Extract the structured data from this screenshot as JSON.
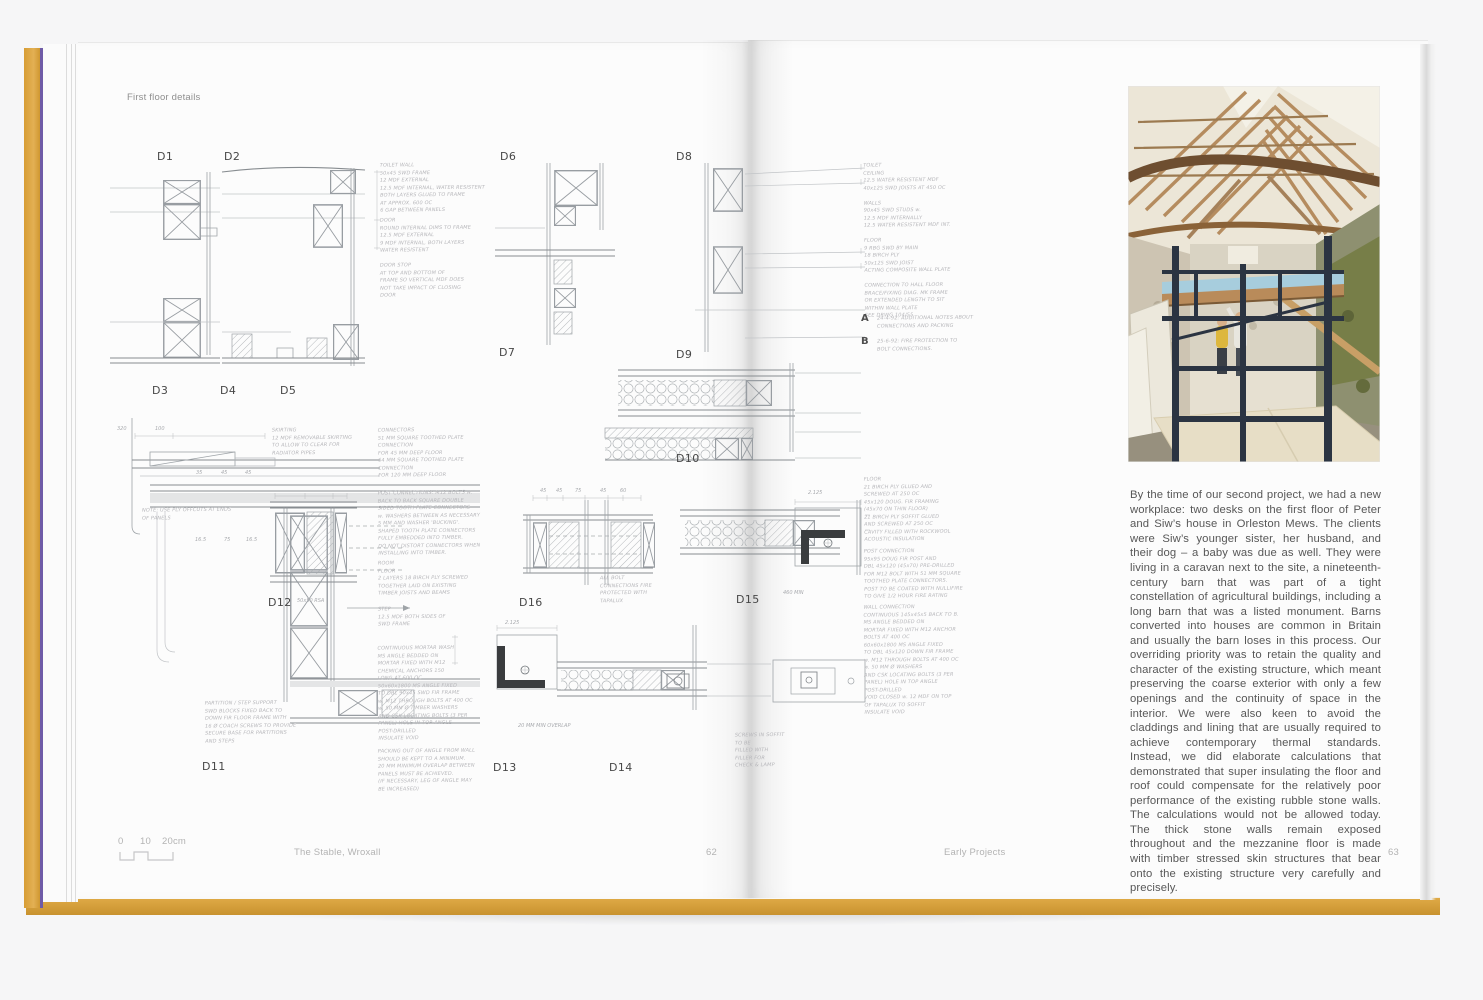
{
  "book": {
    "left_page": {
      "header": "First floor details",
      "footer": {
        "scale_zero": "0",
        "scale_ten": "10",
        "scale_twenty": "20cm",
        "title": "The Stable, Wroxall",
        "page_number": "62"
      }
    },
    "right_page": {
      "footer": {
        "title": "Early Projects",
        "page_number": "63"
      },
      "paragraph": "By the time of our second project, we had a new workplace: two desks on the first floor of Peter and Siw’s house in Orleston Mews. The clients were Siw’s younger sister, her husband, and their dog – a baby was due as well. They were living in a caravan next to the site, a nineteenth-century barn that was part of a tight constellation of agricultural buildings, including a long barn that was a listed monument. Barns converted into houses are common in Britain and usually the barn loses in this process. Our overriding priority was to retain the quality and character of the existing structure, which meant preserving the coarse exterior with only a few openings and the continuity of space in the interior. We were also keen to avoid the claddings and lining that are usually required to achieve contemporary thermal standards. Instead, we did elaborate calculations that demonstrated that super insulating the floor and roof could compensate for the relatively poor performance of the existing rubble stone walls. The calculations would not be allowed today. The thick stone walls remain exposed throughout and the mezzanine floor is made with timber stressed skin structures that bear onto the existing structure very carefully and precisely."
    },
    "drawing": {
      "labels": {
        "d1": "D1",
        "d2": "D2",
        "d3": "D3",
        "d4": "D4",
        "d5": "D5",
        "d6": "D6",
        "d7": "D7",
        "d8": "D8",
        "d9": "D9",
        "d10": "D10",
        "d11": "D11",
        "d12": "D12",
        "d13": "D13",
        "d14": "D14",
        "d15": "D15",
        "d16": "D16"
      },
      "markers": {
        "a": {
          "letter": "A",
          "text": "24-4-92: ADDITIONAL NOTES ABOUT\nCONNECTIONS AND PACKING"
        },
        "b": {
          "letter": "B",
          "text": "25-6-92: FIRE PROTECTION TO\nBOLT CONNECTIONS."
        }
      },
      "notes": {
        "toilet_wall": "TOILET WALL\n50x45 SWD FRAME\n12 MDF EXTERNAL\n12.5 MDF INTERNAL, WATER RESISTENT\nBOTH LAYERS GLUED TO FRAME\nAT APPROX. 600 OC\n6 GAP BETWEEN PANELS",
        "door": "DOOR\nROUND INTERNAL DIMS TO FRAME\n12.5 MDF EXTERNAL\n9 MDF INTERNAL, BOTH LAYERS\nWATER RESISTENT",
        "door_stop": "DOOR STOP\nAT TOP AND BOTTOM OF\nFRAME SO VERTICAL MDF DOES\nNOT TAKE IMPACT OF CLOSING\nDOOR",
        "toilet_schedule": "TOILET\nCEILING\n12.5 WATER RESISTENT MDF\n40x125 SWD JOISTS AT 450 OC\n\nWALLS\n90x45 SWD STUDS w.\n12.5 MDF INTERNALLY\n12.5 WATER RESISTENT MDF INT.\n\nFLOOR\n9 RBG SWD BY MAIN\n18 BIRCH PLY\n50x125 SWD JOIST\nACTING COMPOSITE WALL PLATE\n\nCONNECTION TO HALL FLOOR\nBRACE/FIXING DIAG. MK FRAME\nOR EXTENDED LENGTH TO SIT\nWITHIN WALL PLATE\nSEE DRWG 104/55",
        "skirting": "SKIRTING\n12 MDF REMOVABLE SKIRTING\nTO ALLOW TO CLEAR FOR\nRADIATOR PIPES",
        "connectors": "CONNECTORS\n51 MM SQUARE TOOTHED PLATE CONNECTION\nFOR 45 MM DEEP FLOOR\n64 MM SQUARE TOOTHED PLATE CONNECTION\nFOR 120 MM DEEP FLOOR",
        "ply_note": "NOTE: USE PLY OFFCUTS AT ENDS\nOF PANELS",
        "post_connections": "POST CONNECTIONS: M12 BOLTS w.\nBACK TO BACK SQUARE DOUBLE\nSIDED TOOTH PLATE CONNECTORS\nw. WASHERS BETWEEN AS NECESSARY\n5 MM AND WASHER 'BUCKING'.\nSHAPED TOOTH PLATE CONNECTORS\nFULLY EMBEDDED INTO TIMBER.\nDO NOT DISTORT CONNECTORS WHEN\nINSTALLING INTO TIMBER.",
        "room_floor": "ROOM\nFLOOR\n2 LAYERS 18 BIRCH PLY SCREWED\nTOGETHER LAID ON EXISTING\nTIMBER JOISTS AND BEAMS",
        "step": "STEP\n12.5 MDF BOTH SIDES OF\nSWD FRAME",
        "continuous_angle": "CONTINUOUS MORTAR WASH\nMS ANGLE BEDDED ON\nMORTAR FIXED WITH M12\nCHEMICAL ANCHORS 150\nLONG AT 600 OC\n50x60x1800 MS ANGLE FIXED\nTO DBL 90x45 SWD FIR FRAME\nw. M12 THROUGH BOLTS AT 400 OC\nw. 50 MM Ø TIMBER WASHERS\nAND CSK LOCATING BOLTS (3 PER\nPANEL) HOLE IN TOP ANGLE\nPOST-DRILLED\nINSULATE VOID",
        "packing": "PACKING OUT OF ANGLE FROM WALL\nSHOULD BE KEPT TO A MINIMUM.\n20 MM MINIMUM OVERLAP BETWEEN\nPANELS MUST BE ACHIEVED.\n(IF NECESSARY, LEG OF ANGLE MAY\nBE INCREASED)",
        "partition": "PARTITION / STEP SUPPORT\nSWD BLOCKS FIXED BACK TO\nDOWN FIR FLOOR FRAME WITH\n16 Ø COACH SCREWS TO PROVIDE\nSECURE BASE FOR PARTITIONS\nAND STEPS",
        "floor_right": "FLOOR\n21 BIRCH PLY GLUED AND\nSCREWED AT 250 OC\n45x120 DOUG. FIR FRAMING\n(45x70 ON THIN FLOOR)\n21 BIRCH PLY SOFFIT GLUED\nAND SCREWED AT 250 OC\nCAVITY FILLED WITH ROCKWOOL\nACOUSTIC INSULATION",
        "post_connection_right": "POST CONNECTION\n95x95 DOUG FIR POST AND\nDBL 45x120 (45x70) PRE-DRILLED\nFOR M12 BOLT WITH 51 MM SQUARE\nTOOTHED PLATE CONNECTORS.\nPOST TO BE COATED WITH NULLIFIRE\nTO GIVE 1/2 HOUR FIRE RATING",
        "wall_connection_right": "WALL CONNECTION\nCONTINUOUS 145x45x5 BACK TO B.\nMS ANGLE BEDDED ON\nMORTAR FIXED WITH M12 ANCHOR\nBOLTS AT 400 OC\n60x60x1800 MS ANGLE FIXED\nTO DBL 45x120 DOWN FIR FRAME\nw. M12 THROUGH BOLTS AT 400 OC\nw. 50 MM Ø WASHERS\nAND CSK LOCATING BOLTS (3 PER\nPANEL) HOLE IN TOP ANGLE\nPOST-DRILLED\nVOID CLOSED w. 12 MDF ON TOP\nOF TAPALUX TO SOFFIT\nINSULATE VOID",
        "bolt_fire": "ALL BOLT\nCONNECTIONS FIRE\nPROTECTED WITH\nTAPALUX",
        "soffit": "SCREWS IN SOFFIT\nTO BE\nFILLED WITH\nFILLER FOR\nCHECK & LAMP"
      },
      "dims": {
        "d320": "320",
        "d100": "100",
        "m35": "35",
        "m45a": "45",
        "m45b": "45",
        "g165a": "16.5",
        "g75": "75",
        "g165b": "16.5",
        "r45a": "45",
        "r45b": "45",
        "r75": "75",
        "r45c": "45",
        "r60": "60",
        "rsa": "50x50 RSA",
        "ov": "20 MM MIN OVERLAP",
        "x2125a": "2.125",
        "x2125b": "2.125",
        "min460": "460 MIN"
      }
    },
    "colors": {
      "cover": "#D8A23B",
      "cover_edge": "#6F5BA7",
      "page": "#FCFCFC",
      "handwriting": "#B6B6BA",
      "footer_text": "#B3B3B3",
      "body_text": "#575757",
      "scaffold": "#2B3442",
      "tarp": "#A7CDDD",
      "roof_timber": "#B68D60",
      "moss_wall": "#72793F"
    }
  }
}
